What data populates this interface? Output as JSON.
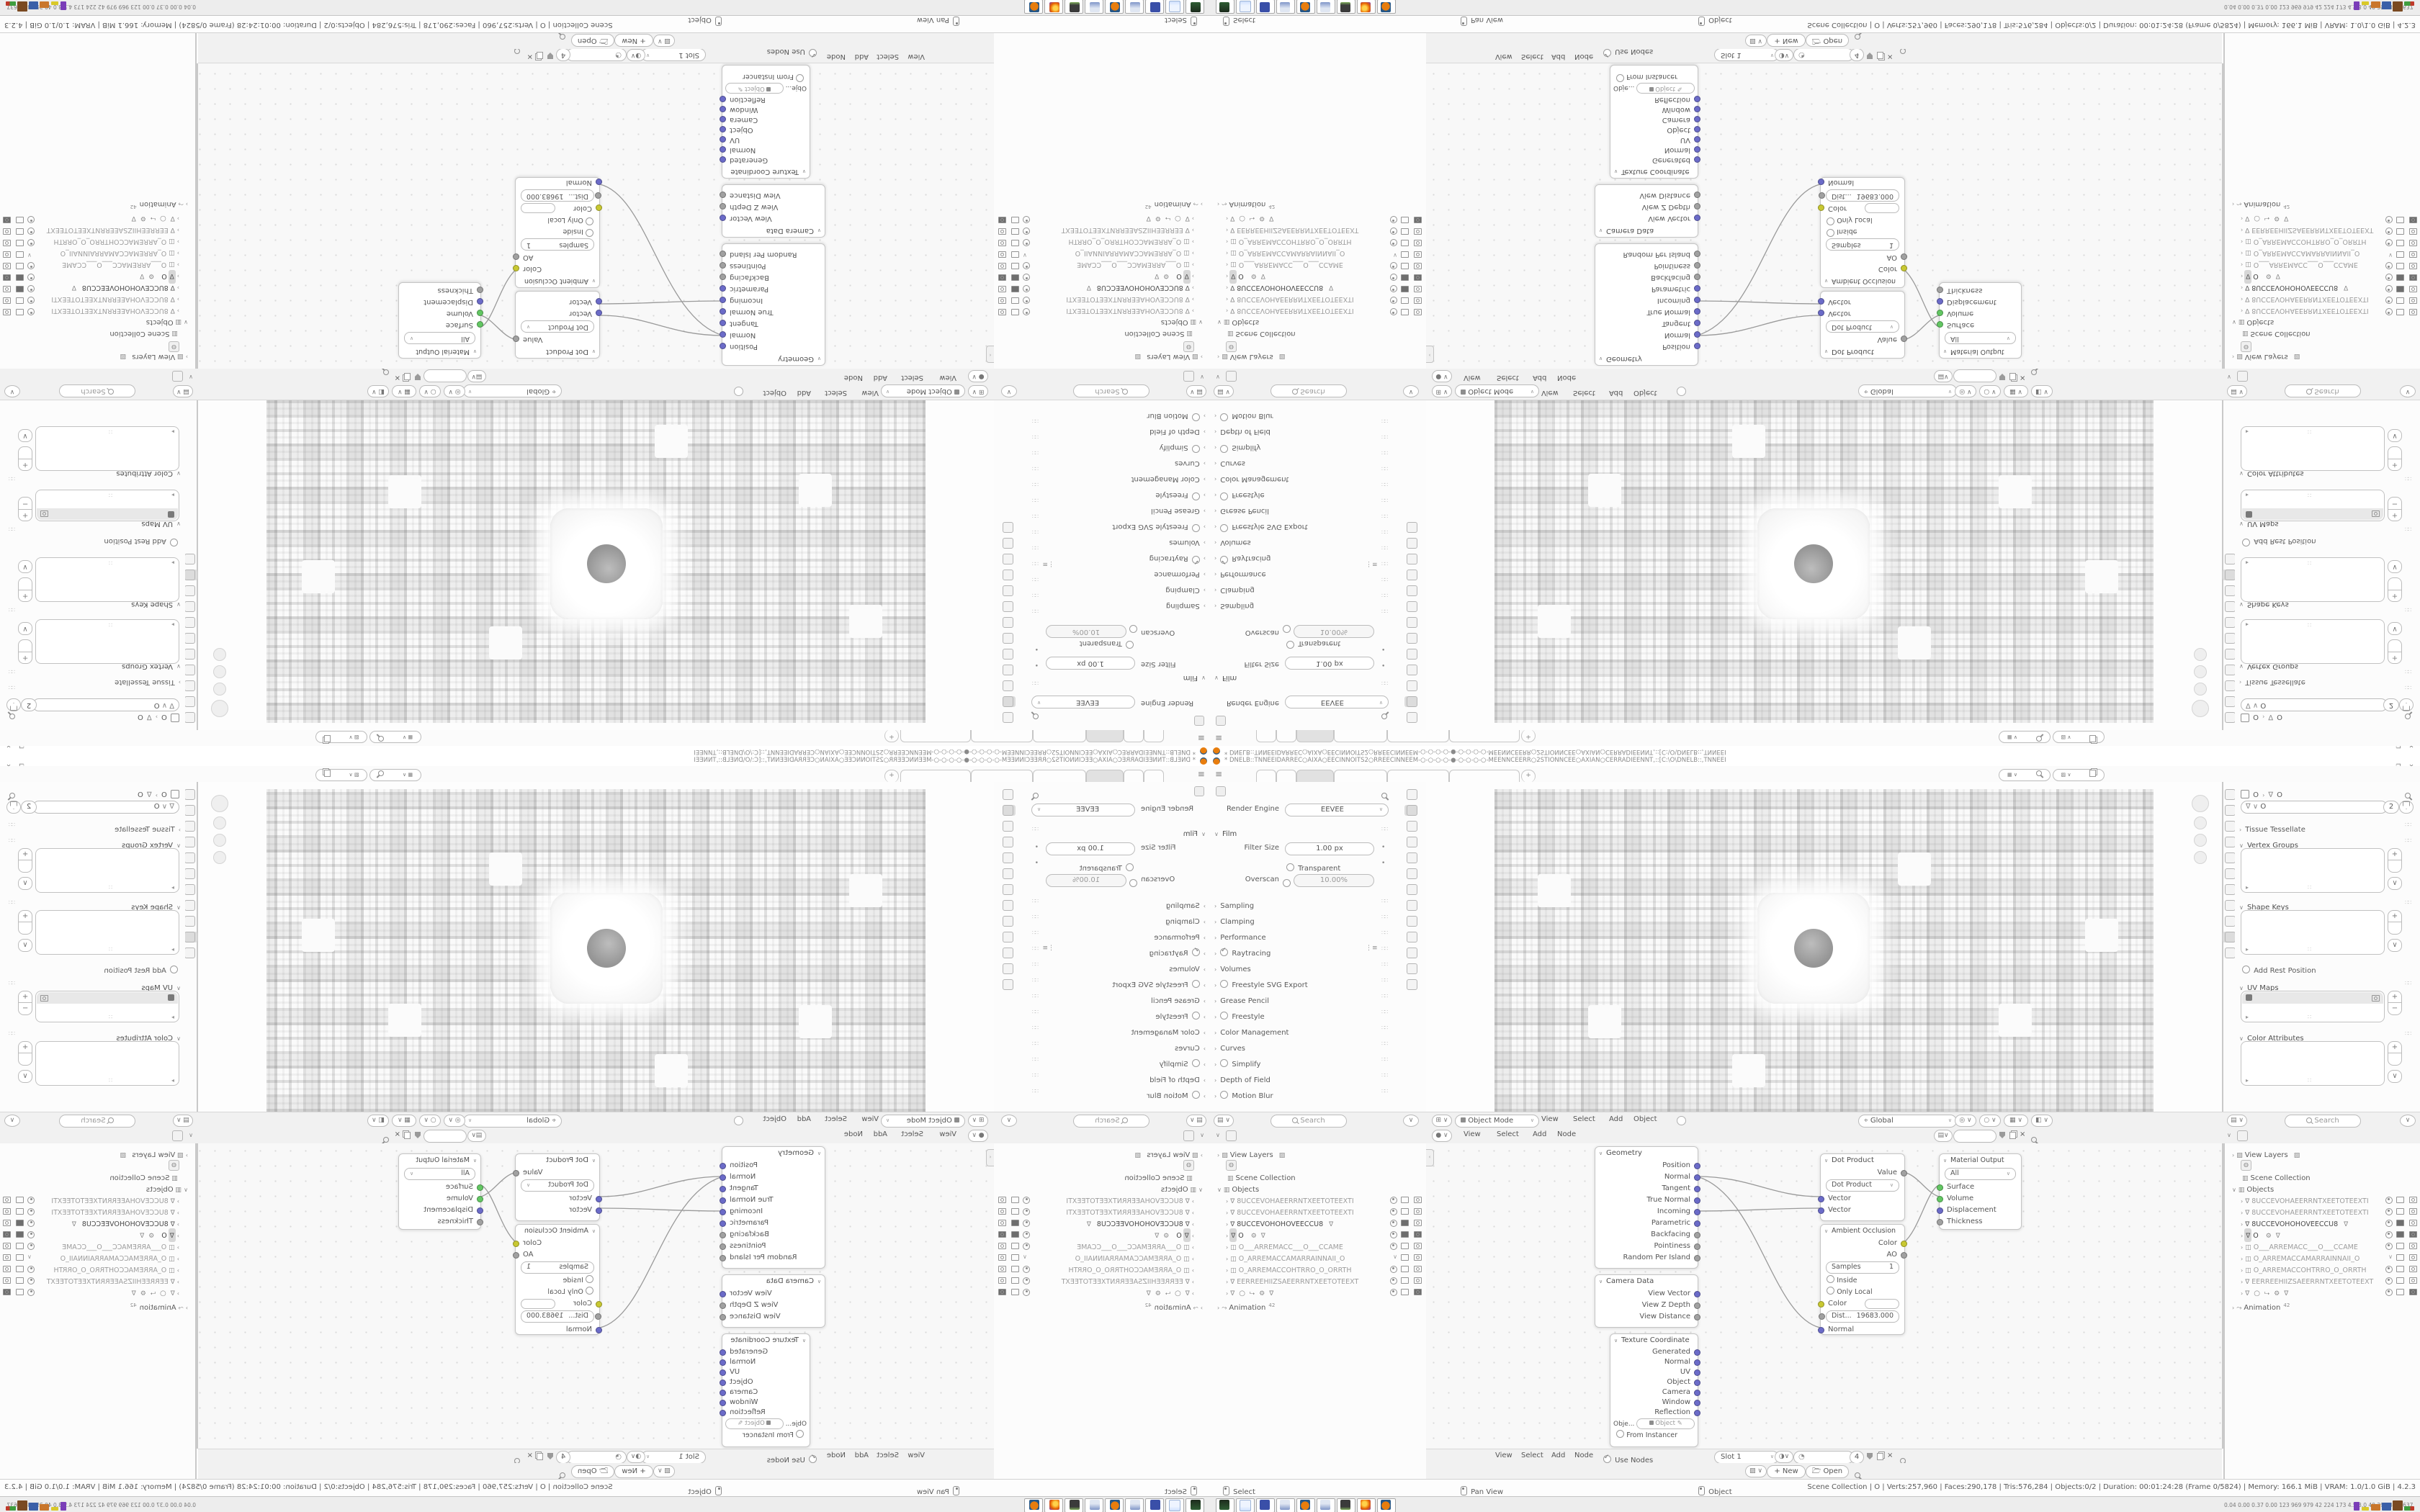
{
  "window": {
    "title": "* DNELB::TNNEEIDARREC○AIXA○EECINNOITS2○RREECINNEEM-○-○-○-○-●-○-○-○-○-MEENNCEERR○2STIONNCEE○AXIAN○CERRADIEENNT,::[C:\\O\\DNELB::,TNNEEI",
    "minimize": "—",
    "maximize": "❐",
    "close": "✕"
  },
  "topbar": {
    "menu_icon": "≡",
    "tabs": [
      "",
      "",
      "",
      "",
      "",
      ""
    ],
    "new_tab": "+"
  },
  "scene_bar": {
    "scene_value": "",
    "view_layer_value": ""
  },
  "render_props": {
    "engine_label": "Render Engine",
    "engine_value": "EEVEE",
    "film_label": "Film",
    "filter_size_label": "Filter Size",
    "filter_size_value": "1.00 px",
    "transparent_label": "Transparent",
    "overscan_label": "Overscan",
    "overscan_value": "10.00%",
    "sections": [
      {
        "label": "Sampling"
      },
      {
        "label": "Clamping"
      },
      {
        "label": "Performance"
      },
      {
        "label": "Raytracing"
      },
      {
        "label": "Volumes"
      },
      {
        "label": "Freestyle SVG Export"
      },
      {
        "label": "Grease Pencil"
      },
      {
        "label": "Freestyle"
      },
      {
        "label": "Color Management"
      },
      {
        "label": "Curves"
      },
      {
        "label": "Simplify"
      },
      {
        "label": "Depth of Field"
      },
      {
        "label": "Motion Blur"
      }
    ],
    "search_placeholder": "Search"
  },
  "data_props": {
    "object_name": "O",
    "data_name": "O",
    "users": "2",
    "tissue": "Tissue Tessellate",
    "vertex_groups": "Vertex Groups",
    "shape_keys": "Shape Keys",
    "add_rest": "Add Rest Position",
    "uv_maps": "UV Maps",
    "color_attributes": "Color Attributes",
    "search_placeholder": "Search"
  },
  "viewport": {
    "mode": "Object Mode",
    "menus": [
      "View",
      "Select",
      "Add",
      "Object"
    ],
    "orientation": "Global"
  },
  "node_editor": {
    "top_menus": [
      "View",
      "Select",
      "Add",
      "Node"
    ],
    "bottom_menus": [
      "View",
      "Select",
      "Add",
      "Node"
    ],
    "use_nodes": "Use Nodes",
    "slot": "Slot 1",
    "material_users": "4",
    "nodes": {
      "geometry": {
        "title": "Geometry",
        "outputs": [
          "Position",
          "Normal",
          "Tangent",
          "True Normal",
          "Incoming",
          "Parametric",
          "Backfacing",
          "Pointiness",
          "Random Per Island"
        ]
      },
      "camera_data": {
        "title": "Camera Data",
        "outputs": [
          "View Vector",
          "View Z Depth",
          "View Distance"
        ]
      },
      "texture_coordinate": {
        "title": "Texture Coordinate",
        "outputs": [
          "Generated",
          "Normal",
          "UV",
          "Object",
          "Camera",
          "Window",
          "Reflection"
        ],
        "object_label": "Obje...",
        "object_value": "Object",
        "from_instancer": "From Instancer"
      },
      "dot_product": {
        "title": "Dot Product",
        "output": "Value",
        "operation": "Dot Product",
        "input1": "Vector",
        "input2": "Vector"
      },
      "ambient_occlusion": {
        "title": "Ambient Occlusion",
        "out1": "Color",
        "out2": "AO",
        "samples_label": "Samples",
        "samples_value": "1",
        "inside": "Inside",
        "only_local": "Only Local",
        "color_label": "Color",
        "dist_label": "Dist...",
        "dist_value": "19683.000",
        "normal_label": "Normal"
      },
      "material_output": {
        "title": "Material Output",
        "target": "All",
        "inputs": [
          "Surface",
          "Volume",
          "Displacement",
          "Thickness"
        ]
      }
    }
  },
  "image_editor": {
    "new_label": "New",
    "open_label": "Open"
  },
  "outliner": {
    "view_layers": "View Layers",
    "scene_collection": "Scene Collection",
    "objects": "Objects",
    "items": [
      {
        "name": "8UCCEVOHAEERRNTXEETOTEEXTI"
      },
      {
        "name": "8UCCEVOHAEERRNTXEETOTEEXTI"
      },
      {
        "name": "8UCCEVOHOHOVEECCU8"
      },
      {
        "name": "O"
      },
      {
        "name": "O___ARREMACC___O___CCAME"
      },
      {
        "name": "O_ARREMACCAMARRAINNAII_O"
      },
      {
        "name": "O_ARREMACCOHTRRO_O_ORRTH"
      },
      {
        "name": "EERREEHIIZSAEERRNTXEETOTEEXT"
      },
      {
        "name": "O"
      }
    ],
    "animation": "Animation",
    "animation_count": "42"
  },
  "status_bar": {
    "hints": [
      "Select",
      "Pan View",
      "Object"
    ],
    "stats": "Scene Collection | O | Verts:257,960 | Faces:290,178 | Tris:576,284 | Objects:0/2 | Duration: 00:01:24:28 (Frame 0/5824) | Memory: 166.1 MiB | VRAM: 1.0/1.0 GiB | 4.2.3"
  },
  "taskbar": {
    "apps": [
      "media-app",
      "notepad",
      "disk-64",
      "calculator",
      "blender",
      "calculator",
      "system-monitor",
      "firefox",
      "blender"
    ],
    "monitor_values": "0.04 0.00 0.37 0.00 123 969 979 42 224 173 4.5 3.0 40 39 58627637"
  },
  "colors": {
    "socket_vector": "#6B6BC8",
    "socket_shader": "#63C763",
    "socket_color": "#C8C832",
    "socket_value": "#A1A1A1",
    "accent_orange": "#E87D0D"
  }
}
